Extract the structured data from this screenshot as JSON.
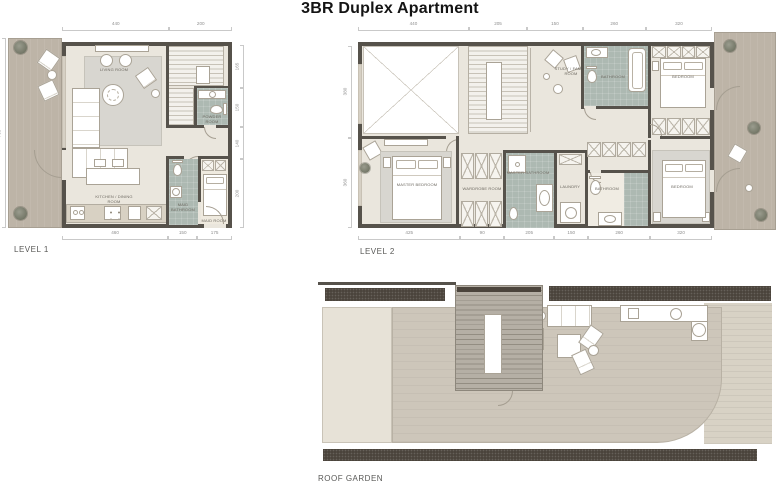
{
  "title": "3BR Duplex Apartment",
  "plans": {
    "level1": {
      "label": "LEVEL 1",
      "rooms": {
        "living": "LIVING ROOM",
        "kitchen": "KITCHEN / DINING ROOM",
        "powder": "POWDER ROOM",
        "maid_bath": "MAID BATHROOM",
        "maid_room": "MAID ROOM"
      },
      "dims_top": [
        "440",
        "200"
      ],
      "dims_bottom": [
        "460",
        "150",
        "175"
      ],
      "dims_right": [
        "165",
        "150",
        "140",
        "200"
      ],
      "dims_left": [
        "700"
      ]
    },
    "level2": {
      "label": "LEVEL 2",
      "rooms": {
        "study": "STUDY / FAMILY ROOM",
        "bath1": "BATHROOM",
        "bedroom1": "BEDROOM",
        "master": "MASTER BEDROOM",
        "wardrobe": "WARDROBE ROOM",
        "master_bath": "MASTER BATHROOM",
        "laundry": "LAUNDRY",
        "bath2": "BATHROOM",
        "bedroom2": "BEDROOM"
      },
      "dims_top": [
        "440",
        "205",
        "150",
        "260",
        "320"
      ],
      "dims_bottom": [
        "425",
        "90",
        "205",
        "150",
        "260",
        "320"
      ],
      "dims_left": [
        "380",
        "360"
      ]
    },
    "roof": {
      "label": "ROOF GARDEN"
    }
  },
  "colors": {
    "wall": "#56524b",
    "floor": "#eae6dd",
    "terrace": "#bdb4a7",
    "bath_tile": "#adb9b2",
    "planter": "#4b443c",
    "roof_deck": "#cdc6ba",
    "rug": "#d8d6d0",
    "dimension_text": "#8f8f8f"
  }
}
